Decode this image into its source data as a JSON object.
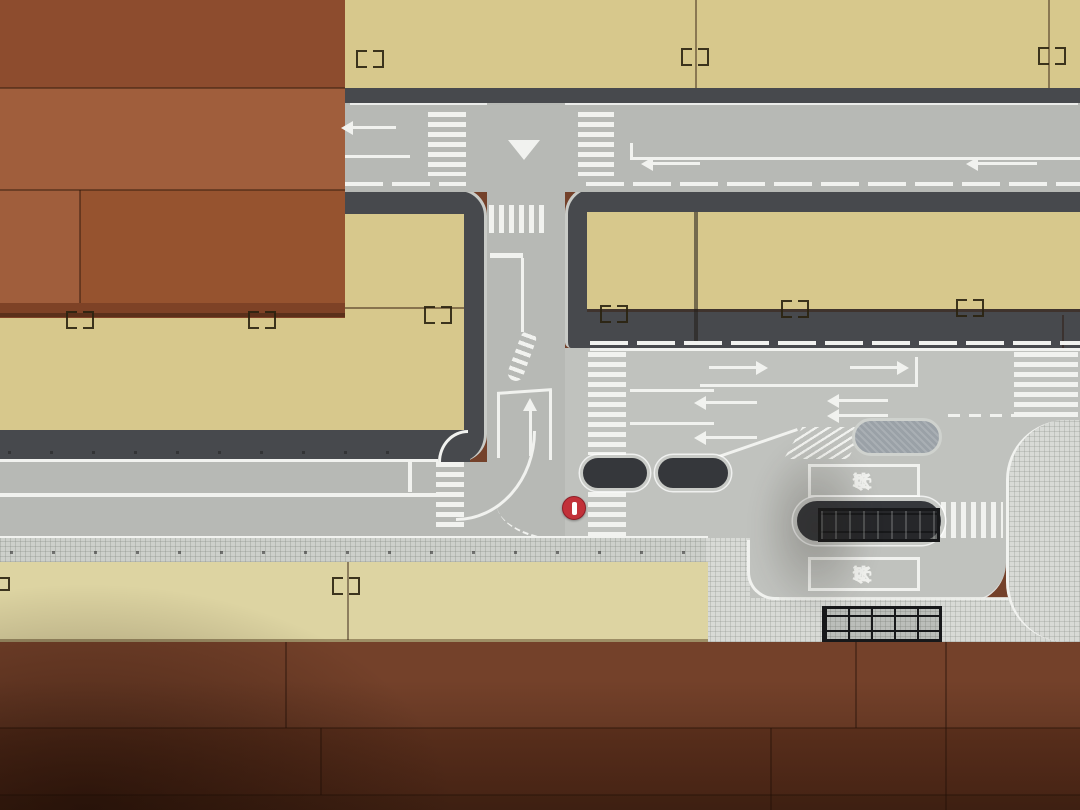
{
  "scene": {
    "type": "top-down photograph",
    "subject": "Toy plastic road plates of a Japanese street set assembled on a reddish-brown wooden plank floor",
    "elements": "T-intersection with crosswalks and yield triangle, multi-lane arterial with lane arrows, two pedestrian refuge islands, bus bay with platform and two bus shelters, red circular road-sign marking, tan blank plates with connector clips"
  },
  "labels": {
    "bus_stop": "バス停",
    "bus_stop_chars": [
      "バ",
      "ス",
      "停"
    ]
  },
  "markings": {
    "crosswalks": 7,
    "west_arrows": 7,
    "east_arrows": 2,
    "up_arrows": 1,
    "refuge_islands": 2,
    "bus_shelters": 2
  },
  "colors": {
    "wood_a": "#8d4c2e",
    "wood_b": "#a05e3c",
    "wood_c": "#96532f",
    "wood_d": "#7e4226",
    "wood_e": "#74412a",
    "wood_f": "#643520",
    "wood_g": "#59301c",
    "tan": "#d7c88c",
    "tan_pale": "#ddd4a2",
    "road": "#b7b9b5",
    "road_light": "#c0c2be",
    "curb": "#47494d",
    "sidewalk": "#cdd0cb",
    "plaza": "#d8dad6",
    "white": "#f1f2ef",
    "island_dark": "#35373b",
    "island_ring": "#c8cac6",
    "island_gray": "#9aa1a7",
    "shelter": "#17181a",
    "red": "#c23139"
  }
}
